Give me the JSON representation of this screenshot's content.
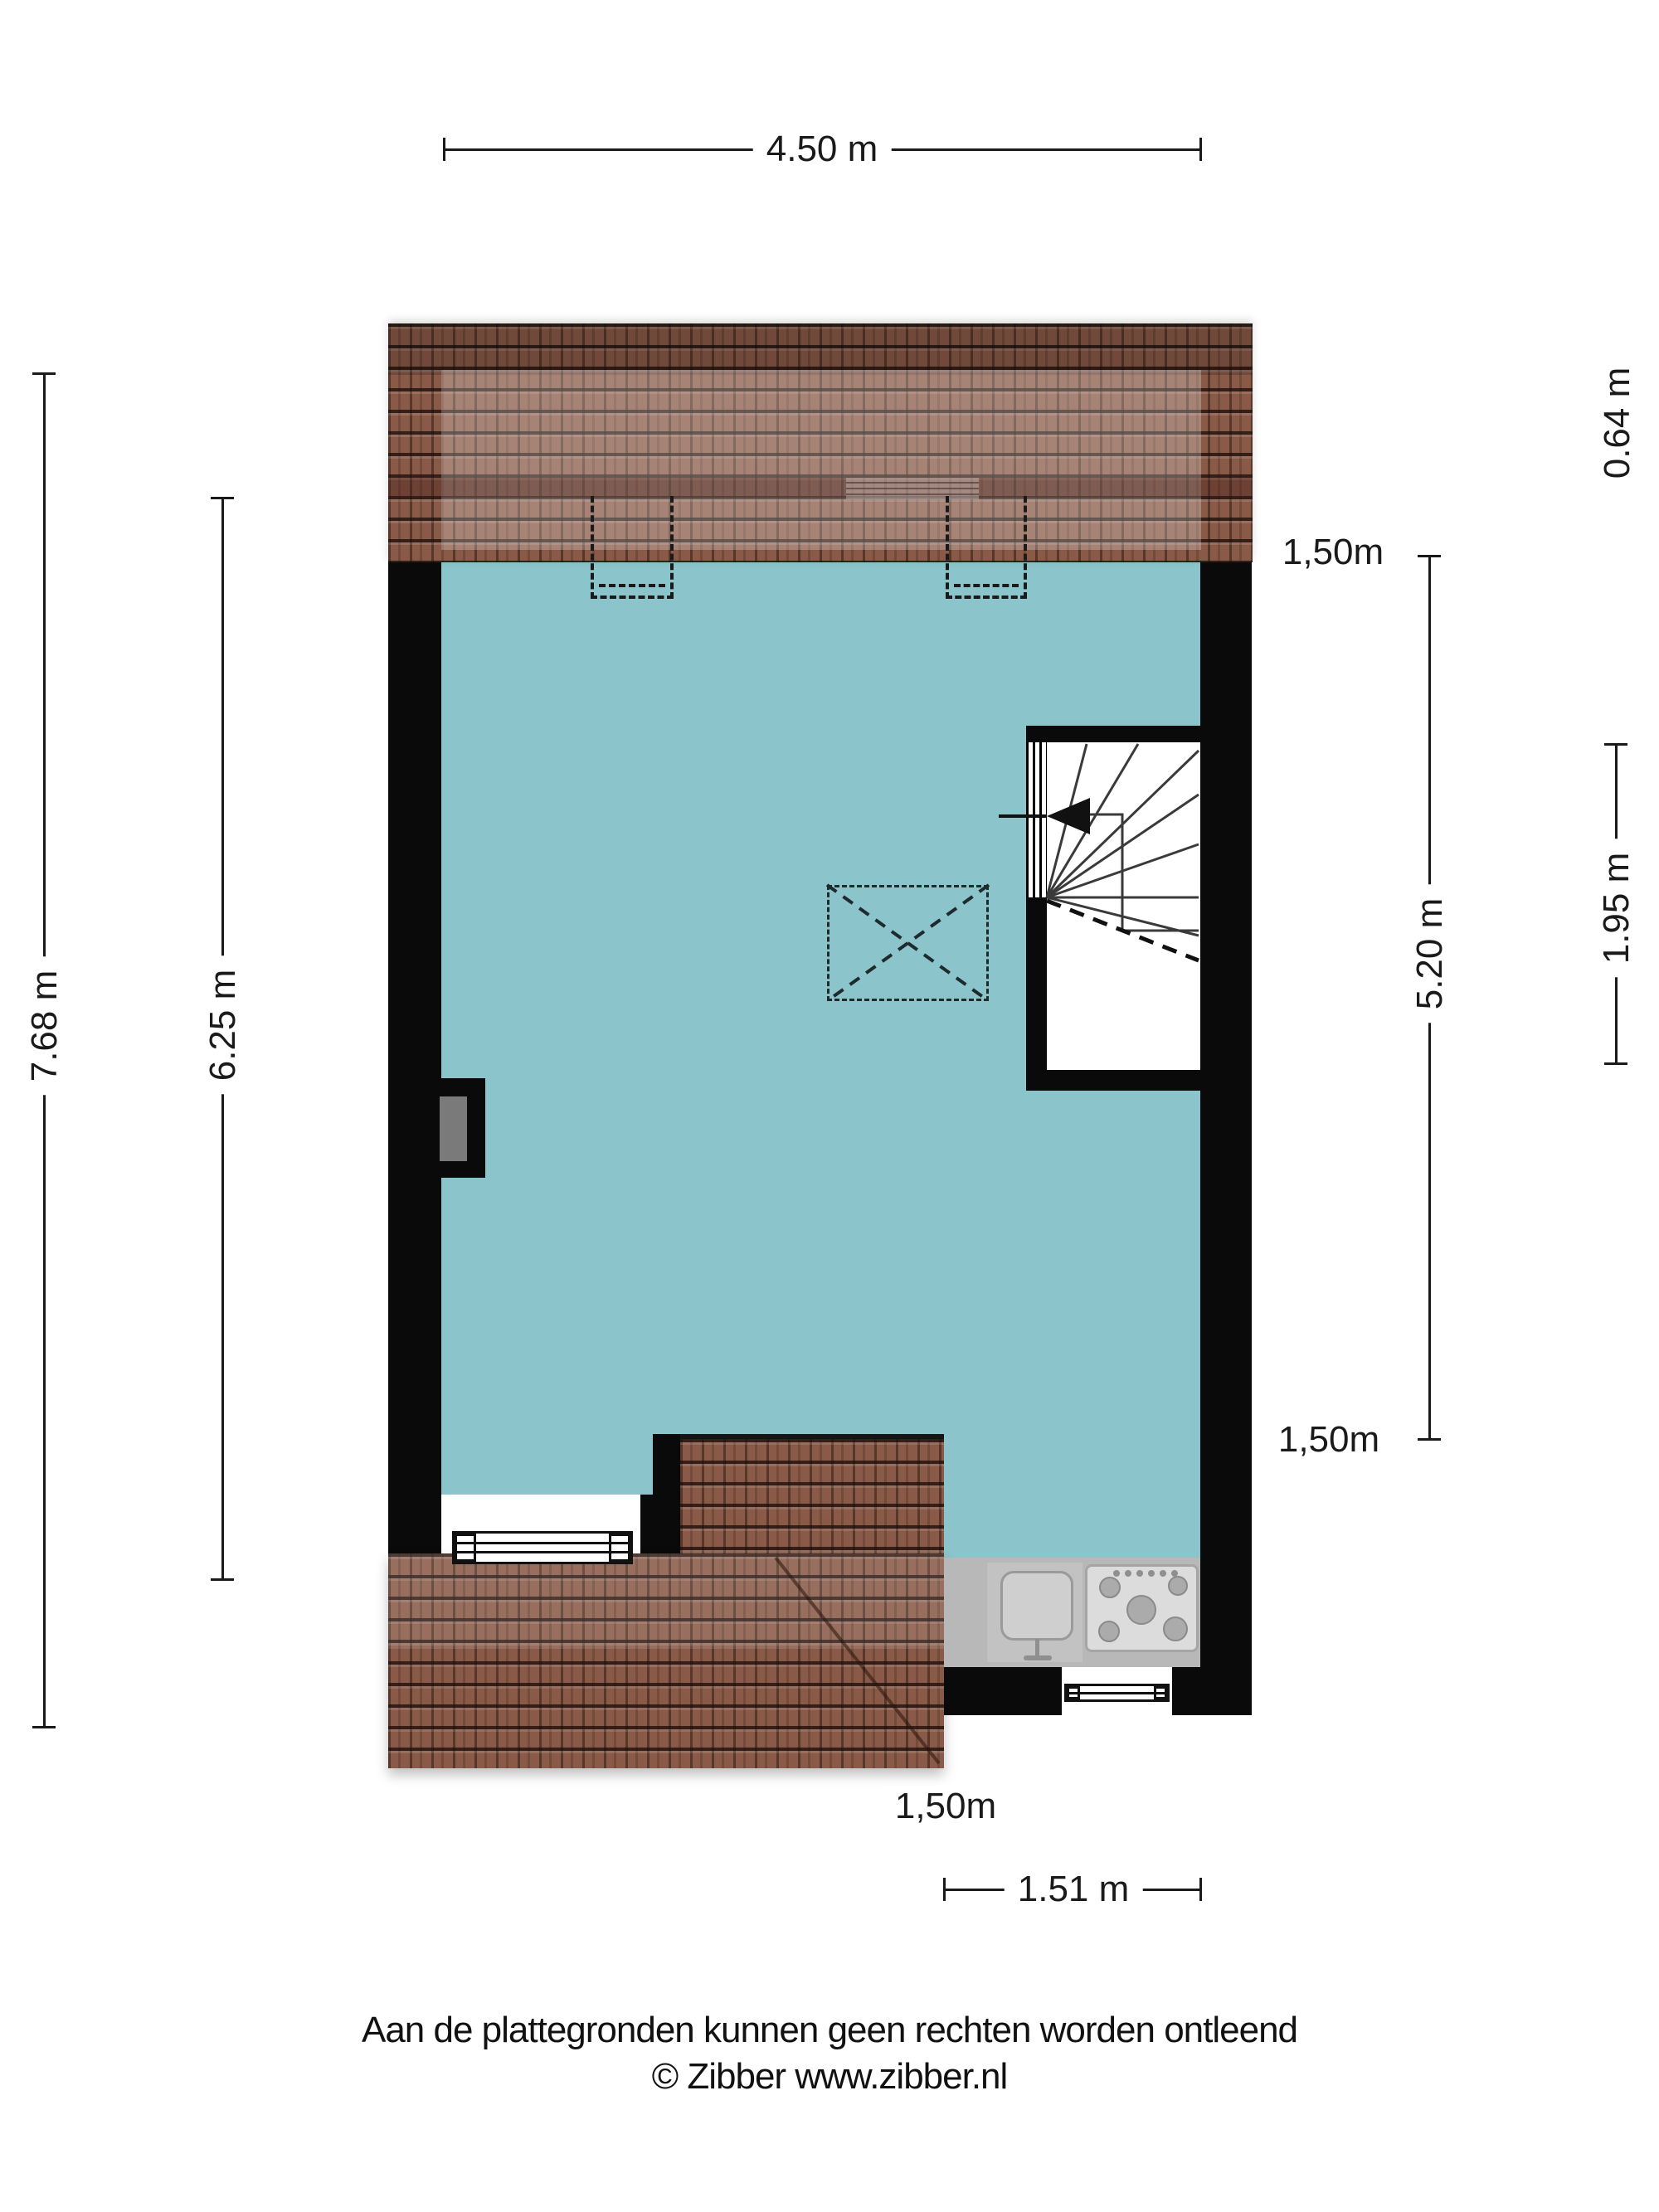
{
  "plan": {
    "title_rooms": {
      "kast": "Kast",
      "slaapkamer": "Slaapkamer",
      "keuken": "Keuken"
    },
    "dimensions": {
      "top_width": "4.50 m",
      "right_roof_depth": "0.64 m",
      "right_knee_top": "1,50m",
      "right_inner_length": "5.20 m",
      "right_outer_length": "1.95 m",
      "right_knee_bottom": "1,50m",
      "left_outer_length": "7.68 m",
      "left_inner_length": "6.25 m",
      "bottom_knee": "1,50m",
      "bottom_width": "1.51 m"
    }
  },
  "footer": {
    "disclaimer": "Aan de plattegronden kunnen geen rechten worden ontleend",
    "copyright": "© Zibber www.zibber.nl"
  },
  "colors": {
    "room_fill": "#8cc4cb",
    "roof_base": "#8a5a48",
    "wall": "#0a0a0a",
    "counter": "#b8b8b8",
    "appliance": "#dcdcdc",
    "dim": "#1a1a1a",
    "niche_gray": "#7a7a7a",
    "bg": "#ffffff"
  }
}
